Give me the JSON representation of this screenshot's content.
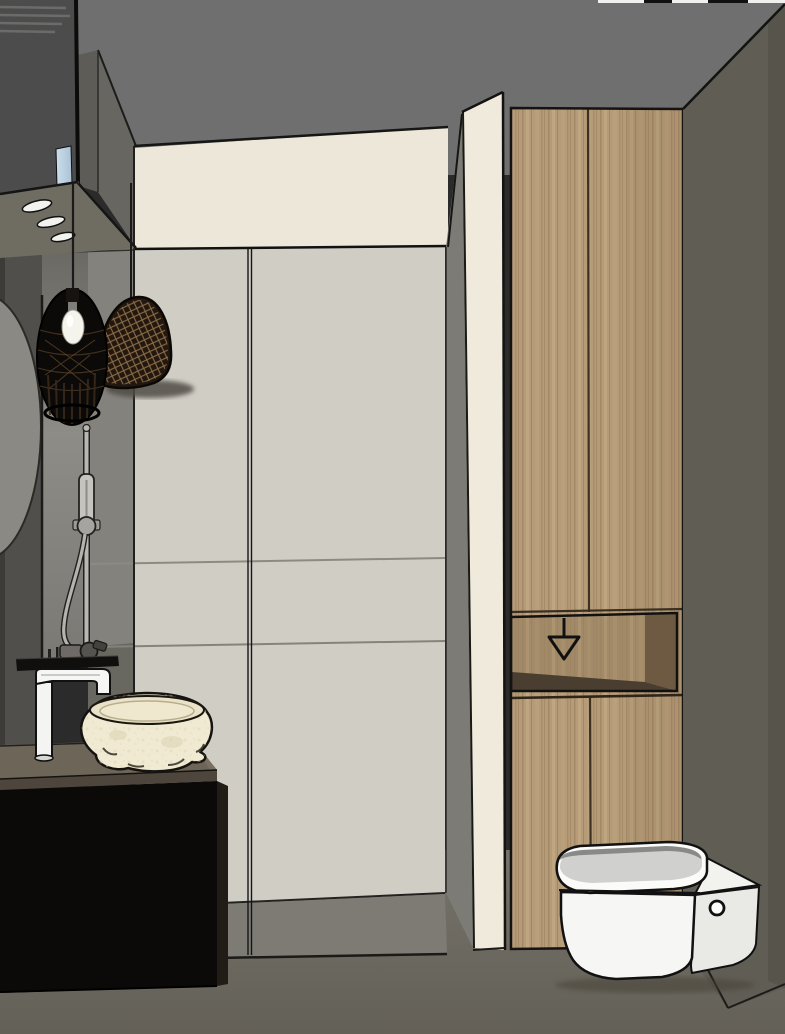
{
  "scene": {
    "title": "3D interior rendering of a modern bathroom",
    "description": "SketchUp-style render: walk-in shower with beige bulkhead and grey large-format tiles, glass screen edge, cream partition pillar, tall oak cabinet with open niche and down-arrow mark, wall-hung white toilet, black vanity with rough stone vessel sink and tall white mixer tap, black rattan pendant lamps, round mirror sliver, overhead black cabinet with three recessed spots",
    "colors": {
      "ceiling": "#6f6f6f",
      "upper_band": "#ece7d8",
      "tile_wall": "#d0cdc5",
      "left_wall_dark": "#514f4b",
      "left_wall_mid": "#84827c",
      "fixture_panel": "#8d8c87",
      "return_strip": "#7d7b75",
      "pillar": "#efeadc",
      "wood": "#b59b77",
      "niche_back": "#a28a68",
      "niche_side": "#6e5a42",
      "niche_bottom": "#4a3e30",
      "right_wall": "#605d55",
      "right_wall_corner": "#57544b",
      "floor": "#6b685e",
      "shower_tray": "#7e7b74",
      "vanity_black": "#0b0a09",
      "countertop": "#6e6559",
      "counter_side": "#7a6f60",
      "stone_sink": "#f1ead2",
      "white_fixture": "#f6f6f4",
      "toilet_seat": "#d0d0ce",
      "lamp_black": "#0c0a08",
      "dome_lamp": "#221810",
      "lamp_weave": "#b28a58",
      "mirror": "#8a8983",
      "overhead_cabinet": "#4c4c4c",
      "underside": "#6f6c62",
      "led_strip_blue": "#cddeeb",
      "outline": "#141414"
    }
  }
}
